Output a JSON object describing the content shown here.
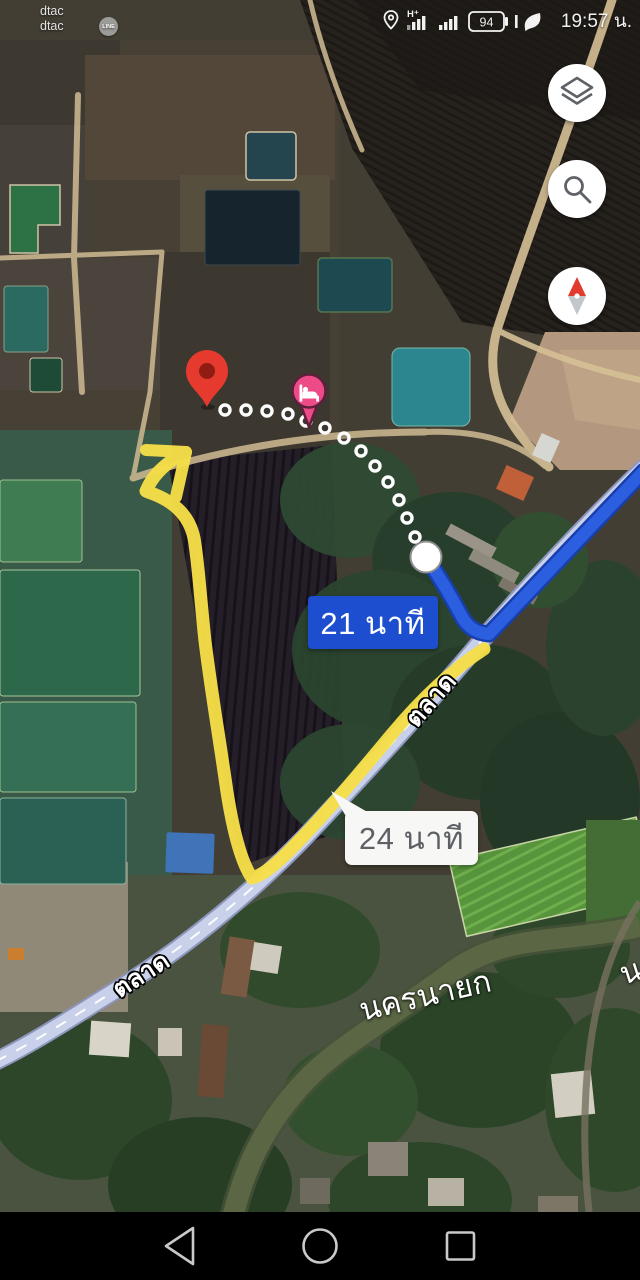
{
  "status_bar": {
    "carrier1": "dtac",
    "carrier2": "dtac",
    "line_badge": "LINE",
    "network_type": "H+",
    "battery_level": "94",
    "time": "19:57 น."
  },
  "route": {
    "primary_duration_label": "21 นาที",
    "alternative_duration_label": "24 นาที"
  },
  "map_labels": {
    "road_upper": "ตลาด",
    "road_lower": "ตลาด",
    "river": "นครนายก",
    "river_partial": "น"
  },
  "icons": {
    "controls": [
      "layers",
      "search",
      "compass"
    ],
    "nav": [
      "back",
      "home",
      "recents"
    ],
    "status": [
      "location",
      "signal-h-plus",
      "signal",
      "battery",
      "power-saving-leaf",
      "line-app"
    ]
  },
  "colors": {
    "primary_route": "#2c5fe0",
    "alternative_route": "#f6df48",
    "duration_badge_bg": "#1d4ed0",
    "road": "#c9d1ea",
    "destination_pin": "#e63a2e",
    "lodging_pin": "#ed4b87"
  }
}
